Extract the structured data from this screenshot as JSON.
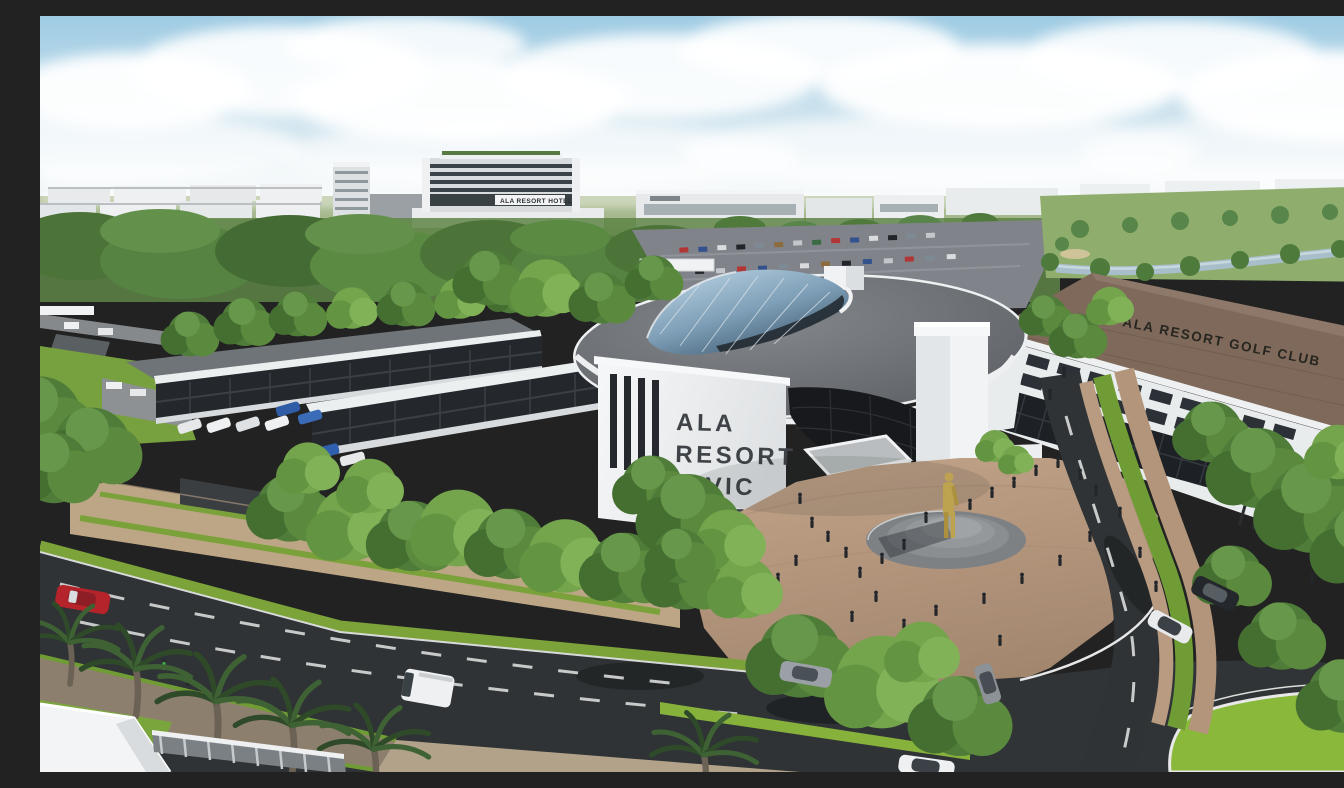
{
  "scene": {
    "type": "aerial-architectural-rendering",
    "signs": {
      "civic_center": {
        "line1": "ALA",
        "line2": "RESORT",
        "line3": "CIVIC",
        "line4": "CENTER"
      },
      "golf_club": "ALA RESORT GOLF CLUB",
      "hotel": "ALA RESORT HOTEL"
    },
    "colors": {
      "sky_top": "#9ecbe3",
      "sky_horizon": "#edf3f3",
      "cloud_white": "#ffffff",
      "field_green": "#9db381",
      "tree_dark": "#3f6b33",
      "tree_mid": "#558340",
      "tree_light": "#74a44c",
      "asphalt": "#2f3335",
      "road_marking": "#d9dbda",
      "plaza_tan": "#b5977e",
      "building_white": "#f2f3f4",
      "roof_gray": "#676b6f",
      "glass_dark": "#17191c",
      "skylight_blue": "#9cc0d8",
      "golf_roof_brown": "#7e695b",
      "statue_gold": "#bda24f",
      "grass_green": "#7ea93c",
      "palm_green": "#2f4a28",
      "car_red": "#b5232b"
    }
  }
}
